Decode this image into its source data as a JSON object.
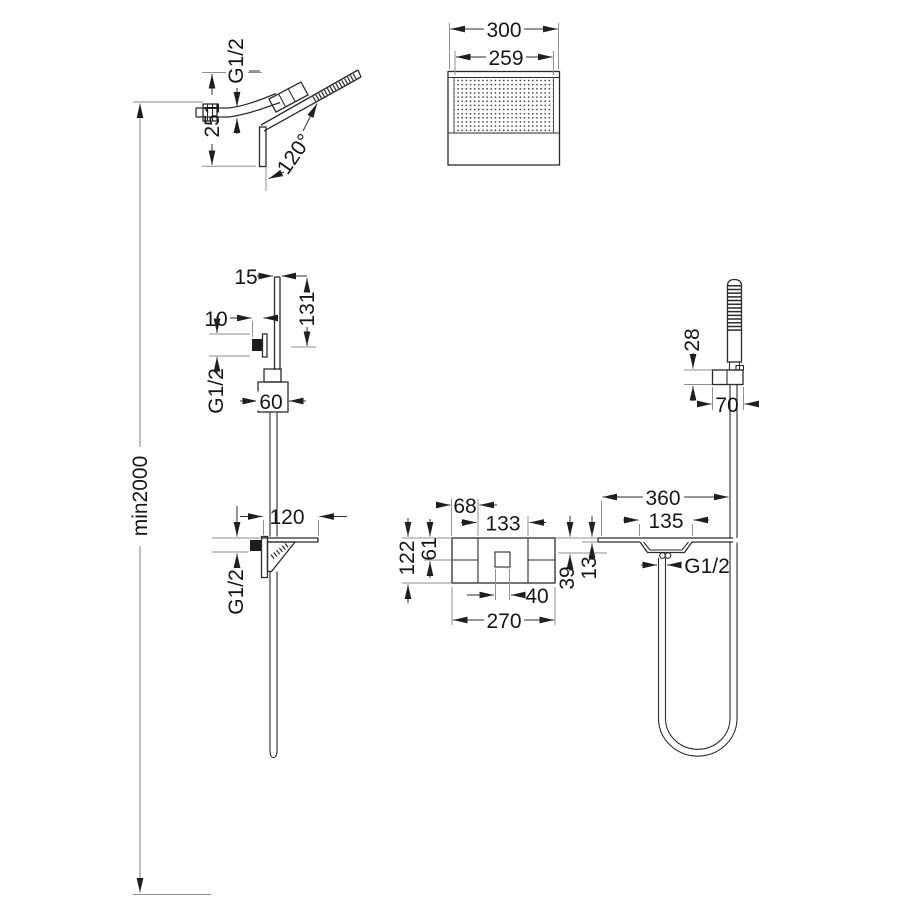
{
  "colors": {
    "background": "#ffffff",
    "line": "#2b2b2b",
    "dimension": "#2e2e2e",
    "light_line": "#8f8f8f"
  },
  "views": {
    "overall": {
      "min_height_label": "min2000"
    },
    "head_side": {
      "thread": "G1/2",
      "height": "251",
      "angle": "120°"
    },
    "head_front": {
      "overall_width": "300",
      "spray_face_width": "259"
    },
    "holder_side": {
      "arm_thickness": "15",
      "arm_length": "131",
      "projection": "10",
      "thread": "G1/2",
      "escutcheon_width": "60"
    },
    "hand_shower": {
      "bracket_height": "28",
      "bracket_width": "70"
    },
    "spout_side": {
      "projection": "120",
      "thread": "G1/2"
    },
    "mixer_front": {
      "left_section_width": "68",
      "center_section_width": "133",
      "upper_section_height": "61",
      "overall_height": "122",
      "knob_width": "40",
      "overall_width": "270"
    },
    "spout_front": {
      "overall_width": "360",
      "spout_width": "135",
      "spout_height": "39",
      "shelf_thickness": "13",
      "thread": "G1/2"
    }
  }
}
